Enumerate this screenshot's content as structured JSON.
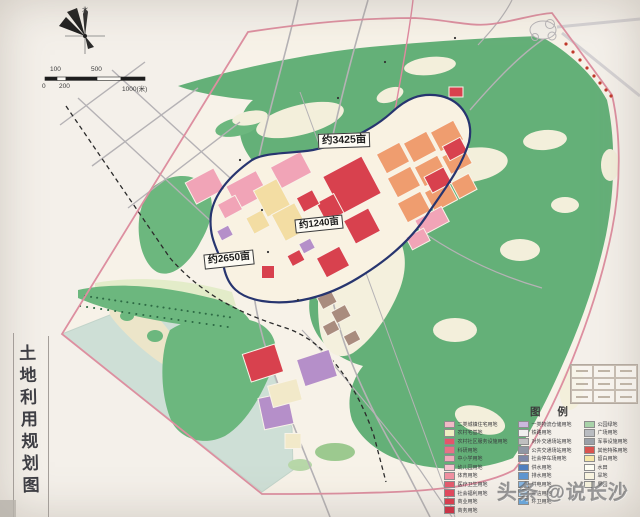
{
  "page_title": "土地利用规划图",
  "compass": {
    "north_label": "北"
  },
  "scale_bar": {
    "labels_above": [
      "100",
      "500"
    ],
    "labels_below": [
      "0",
      "200",
      "1000(米)"
    ]
  },
  "map": {
    "area_labels": [
      {
        "text": "约3425亩"
      },
      {
        "text": "约1240亩"
      },
      {
        "text": "约2650亩"
      }
    ]
  },
  "legend": {
    "title": "图  例",
    "columns": [
      {
        "items": [
          {
            "color": "#f2b9c6",
            "label": "二类城镇住宅用地"
          },
          {
            "color": "#efeec3",
            "label": "农村宅基地"
          },
          {
            "color": "#e4556a",
            "label": "农村社区服务设施用地"
          },
          {
            "color": "#e87286",
            "label": "科研用地"
          },
          {
            "color": "#f3aabb",
            "label": "中小学用地"
          },
          {
            "color": "#f7c3cf",
            "label": "幼儿园用地"
          },
          {
            "color": "#ef8f9f",
            "label": "体育用地"
          },
          {
            "color": "#e25b6c",
            "label": "医疗卫生用地"
          },
          {
            "color": "#de4a5e",
            "label": "社会福利用地"
          },
          {
            "color": "#d63f50",
            "label": "商业用地"
          },
          {
            "color": "#c93648",
            "label": "商务用地"
          }
        ]
      },
      {
        "items": [
          {
            "color": "#cbb8dd",
            "label": "一类物流仓储用地"
          },
          {
            "color": "#f0f0ef",
            "label": "铁路用地"
          },
          {
            "color": "#bfbfbf",
            "label": "对外交通场站用地"
          },
          {
            "color": "#8f96a3",
            "label": "公共交通场站用地"
          },
          {
            "color": "#7d88a8",
            "label": "社会停车场用地"
          },
          {
            "color": "#4f7fbe",
            "label": "供水用地"
          },
          {
            "color": "#5e95cf",
            "label": "排水用地"
          },
          {
            "color": "#86b4e0",
            "label": "供电用地"
          },
          {
            "color": "#a7cbe8",
            "label": "通信用地"
          },
          {
            "color": "#6aa5d8",
            "label": "环卫用地"
          }
        ]
      },
      {
        "items": [
          {
            "color": "#a8d2a8",
            "label": "公园绿地"
          },
          {
            "color": "#b9bcc1",
            "label": "广场用地"
          },
          {
            "color": "#9aa0a8",
            "label": "军事设施用地"
          },
          {
            "color": "#d9534f",
            "label": "其他特殊用地"
          },
          {
            "color": "#f5e6a8",
            "label": "留白用地"
          },
          {
            "color": "#fdfdf3",
            "label": "水田"
          },
          {
            "color": "#f8f3df",
            "label": "旱地"
          },
          {
            "color": "#f3efda",
            "label": "果园"
          }
        ]
      }
    ]
  },
  "watermark": {
    "text": "头条 @说长沙"
  },
  "colors": {
    "paper": "#f4f0ea",
    "plan_area_fill": "#f7f2e8",
    "boundary_pink": "#dd8fa0",
    "dev_boundary_navy": "#27356f",
    "forest_green": "#64b078",
    "water_blue": "#cedfd6",
    "residential_pink": "#f1a4b7",
    "commercial_red": "#d8414e",
    "industrial_orange": "#ef9d6f",
    "village_yellow": "#f3dda3",
    "logistics_purple": "#b58fc9",
    "road_gray": "#b5b2b5"
  }
}
